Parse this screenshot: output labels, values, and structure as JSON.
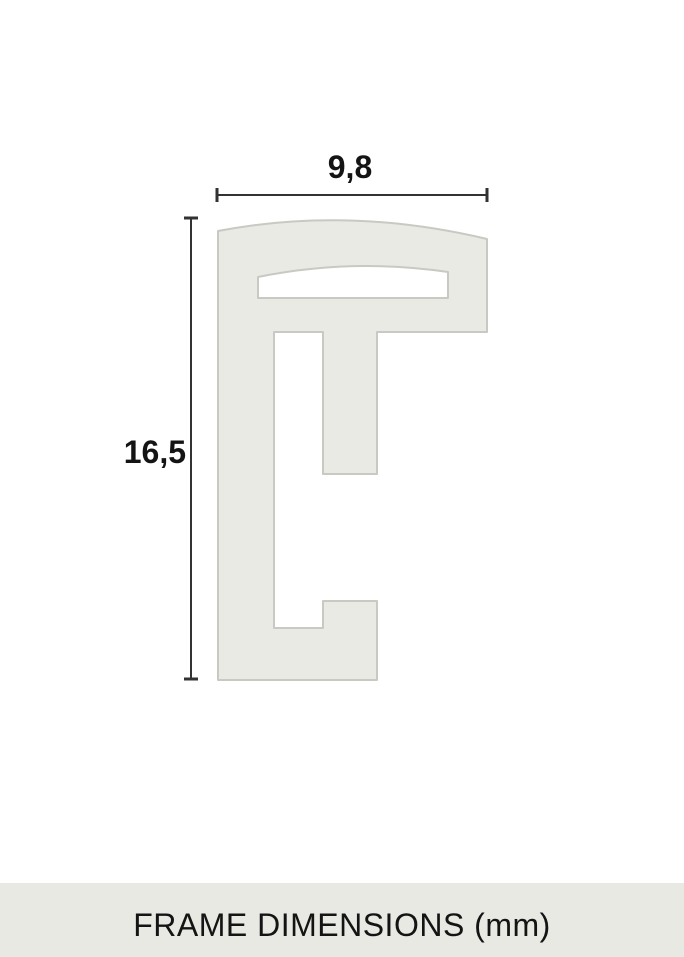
{
  "diagram": {
    "width_label": "9,8",
    "height_label": "16,5",
    "unit": "mm"
  },
  "caption": "FRAME DIMENSIONS (mm)",
  "colors": {
    "background": "#ffffff",
    "profile_fill": "#e9eae4",
    "profile_stroke": "#c8c9c2",
    "dimension_line": "#323232",
    "text_color": "#141414",
    "caption_band": "#e8e9e3"
  }
}
